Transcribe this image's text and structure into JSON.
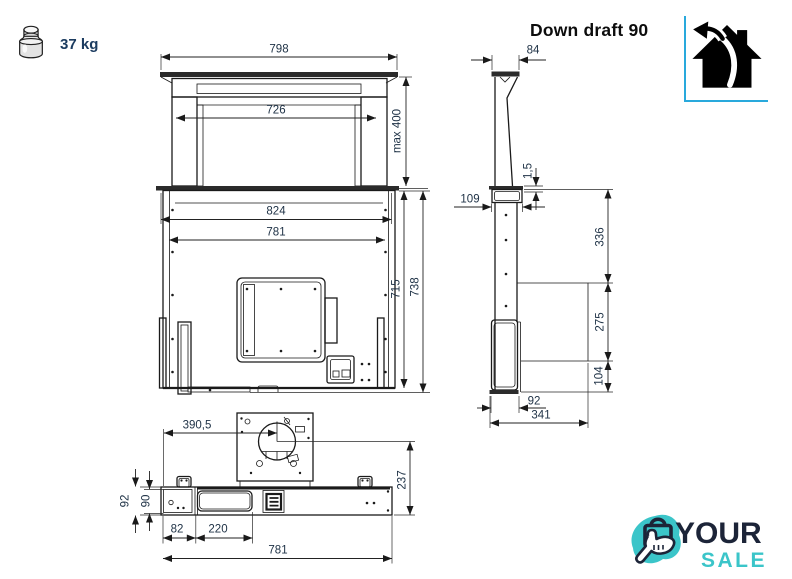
{
  "header": {
    "weight_label": "37 kg",
    "product_title": "Down draft 90"
  },
  "colors": {
    "drawing_line": "#1a1a1a",
    "dim_text": "#203347",
    "weight_text": "#1c3c60",
    "house_border_blue": "#29a9dc",
    "logo_navy": "#1c2438",
    "logo_teal": "#3bc5c9"
  },
  "icons": {
    "weight": "weight-icon",
    "house_recirculation": "house-recirculation-icon",
    "shopping_bag_hand": "shopping-bag-hand-icon"
  },
  "front_view": {
    "label": "front view technical drawing",
    "dims": {
      "d798": "798",
      "d726": "726",
      "max400": "max 400",
      "d824": "824",
      "d781": "781",
      "d715": "715",
      "d738": "738"
    }
  },
  "side_view": {
    "label": "side view technical drawing",
    "dims": {
      "d84": "84",
      "d1_5": "1,5",
      "d109": "109",
      "d336": "336",
      "d275": "275",
      "d104": "104",
      "d92": "92",
      "d341": "341"
    }
  },
  "bottom_view": {
    "label": "bottom view technical drawing",
    "dims": {
      "d390_5": "390,5",
      "d237": "237",
      "d92": "92",
      "d90": "90",
      "d82": "82",
      "d220": "220",
      "d781": "781"
    }
  },
  "footer_logo": {
    "line1": "YOUR",
    "line2": "SALE"
  }
}
